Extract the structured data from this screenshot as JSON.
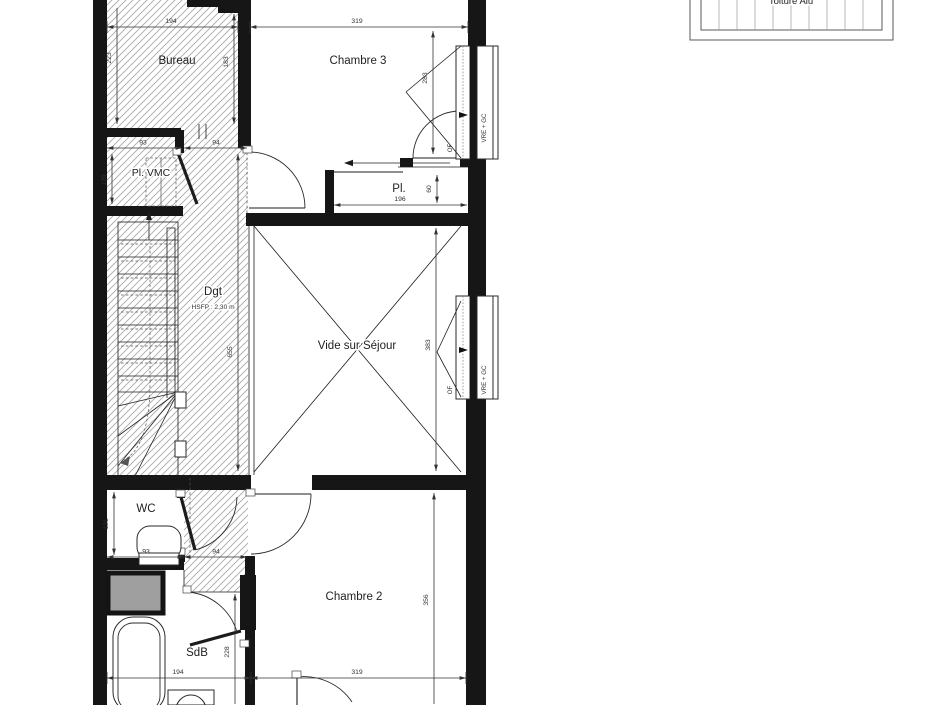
{
  "title_block": {
    "label": "Toiture Alu"
  },
  "rooms": {
    "bureau": {
      "label": "Bureau"
    },
    "chambre3": {
      "label": "Chambre 3"
    },
    "pl_vmc": {
      "label": "Pl. VMC"
    },
    "degagement": {
      "label": "Dgt",
      "note": "HSFP : 2,30 m"
    },
    "placard": {
      "label": "Pl."
    },
    "vide": {
      "label": "Vide sur Séjour"
    },
    "wc": {
      "label": "WC"
    },
    "sdb": {
      "label": "SdB"
    },
    "chambre2": {
      "label": "Chambre 2"
    }
  },
  "windows": {
    "of_label": "OF",
    "note_label": "VRE + GC"
  },
  "dims": {
    "bureau_width": "194",
    "bureau_height": "223",
    "bureau_door_side": "183",
    "chambre3_width": "319",
    "chambre3_height": "283",
    "pl_vmc_width": "93",
    "corridor_top_width": "94",
    "pl_vmc_height": "120",
    "degagement_length": "655",
    "placard_width": "196",
    "placard_depth": "60",
    "vide_height": "383",
    "wc_height": "121",
    "wc_width": "93",
    "corridor_bottom_width": "94",
    "chambre2_height": "356",
    "chambre2_width": "319",
    "sdb_width": "194",
    "sdb_height": "228"
  },
  "colors": {
    "wall": "#161616",
    "line": "#1c1c1c",
    "hatch": "#a9a9a9",
    "dim": "#333333",
    "shaft_fill": "#9f9f9f",
    "background": "#ffffff"
  }
}
